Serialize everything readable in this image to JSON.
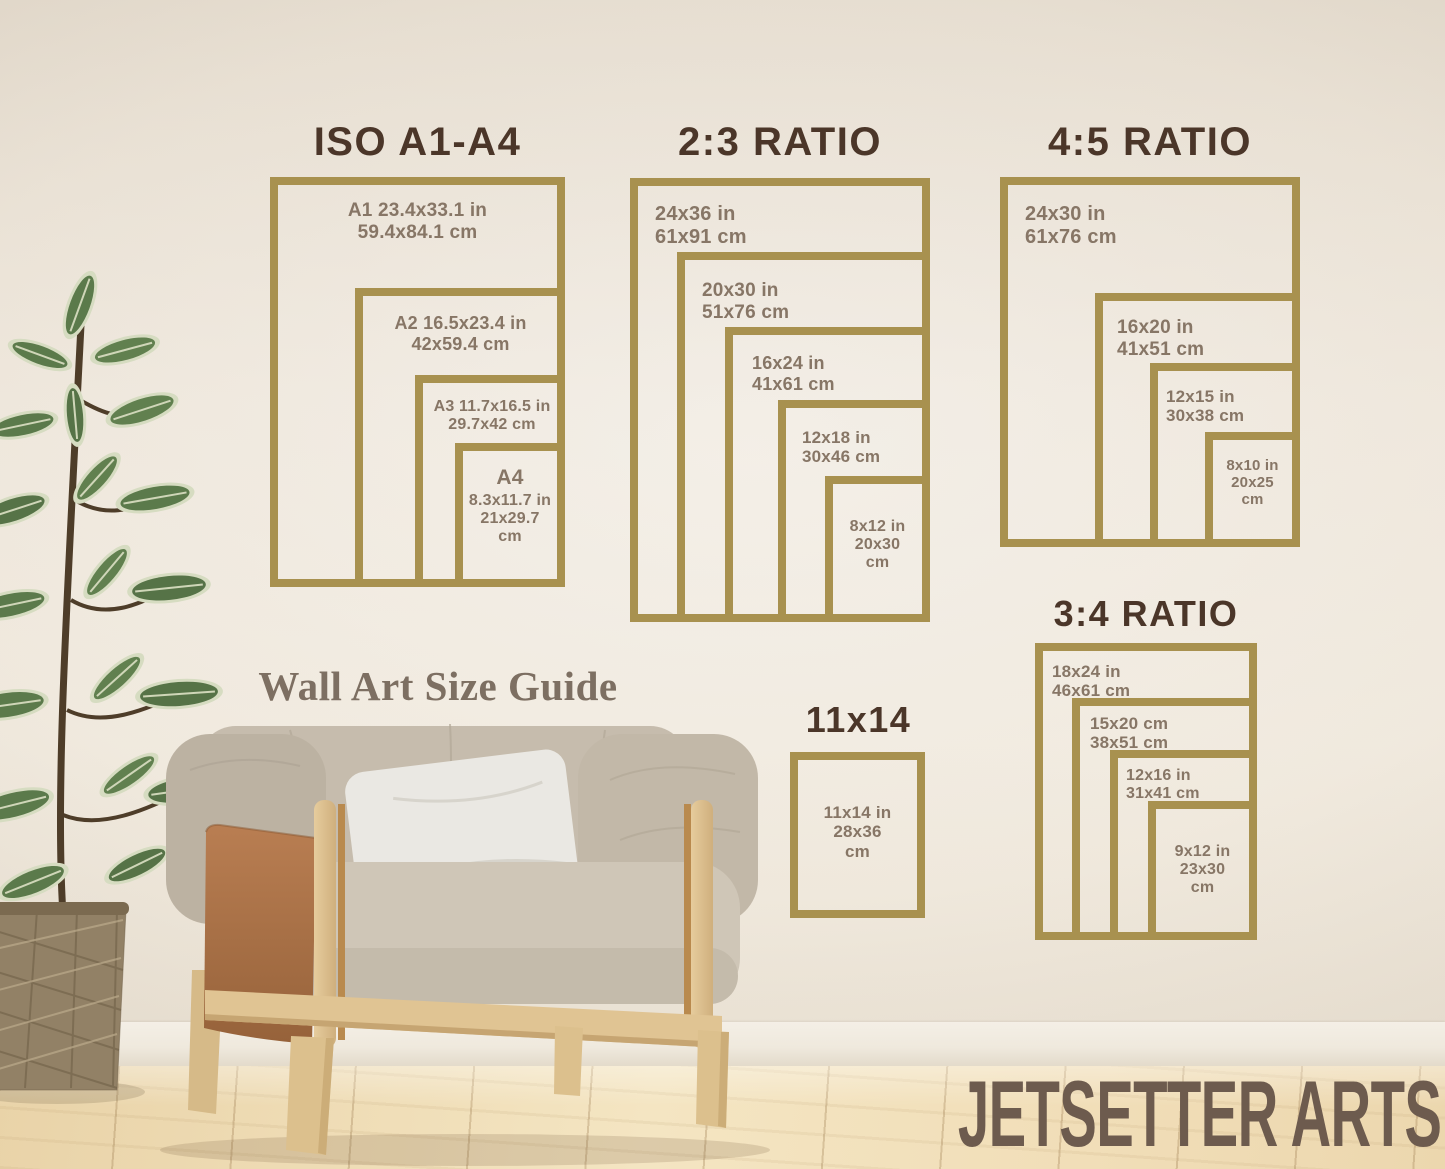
{
  "guide_title": "Wall Art Size Guide",
  "brand": "JETSETTER ARTS",
  "colors": {
    "frame_border": "#a8914f",
    "section_title": "#4b3629",
    "label_text": "#877666",
    "guide_title_color": "#7d6f62",
    "brand_color": "#6d5b4e"
  },
  "sections": [
    {
      "title": "ISO A1-A4",
      "frames": [
        {
          "lines": [
            "A1 23.4x33.1 in",
            "59.4x84.1 cm"
          ]
        },
        {
          "lines": [
            "A2 16.5x23.4 in",
            "42x59.4 cm"
          ]
        },
        {
          "lines": [
            "A3 11.7x16.5 in",
            "29.7x42 cm"
          ]
        },
        {
          "heading": "A4",
          "lines": [
            "8.3x11.7 in",
            "21x29.7",
            "cm"
          ]
        }
      ]
    },
    {
      "title": "2:3 RATIO",
      "frames": [
        {
          "lines": [
            "24x36 in",
            "61x91 cm"
          ]
        },
        {
          "lines": [
            "20x30 in",
            "51x76 cm"
          ]
        },
        {
          "lines": [
            "16x24 in",
            "41x61 cm"
          ]
        },
        {
          "lines": [
            "12x18 in",
            "30x46 cm"
          ]
        },
        {
          "lines": [
            "8x12 in",
            "20x30",
            "cm"
          ]
        }
      ]
    },
    {
      "title": "4:5 RATIO",
      "frames": [
        {
          "lines": [
            "24x30 in",
            "61x76 cm"
          ]
        },
        {
          "lines": [
            "16x20 in",
            "41x51 cm"
          ]
        },
        {
          "lines": [
            "12x15 in",
            "30x38 cm"
          ]
        },
        {
          "lines": [
            "8x10 in",
            "20x25",
            "cm"
          ]
        }
      ]
    },
    {
      "title": "3:4 RATIO",
      "frames": [
        {
          "lines": [
            "18x24 in",
            "46x61 cm"
          ]
        },
        {
          "lines": [
            "15x20 cm",
            "38x51 cm"
          ]
        },
        {
          "lines": [
            "12x16 in",
            "31x41 cm"
          ]
        },
        {
          "lines": [
            "9x12 in",
            "23x30",
            "cm"
          ]
        }
      ]
    },
    {
      "title": "11x14",
      "frames": [
        {
          "lines": [
            "11x14 in",
            "28x36",
            "cm"
          ]
        }
      ]
    }
  ]
}
